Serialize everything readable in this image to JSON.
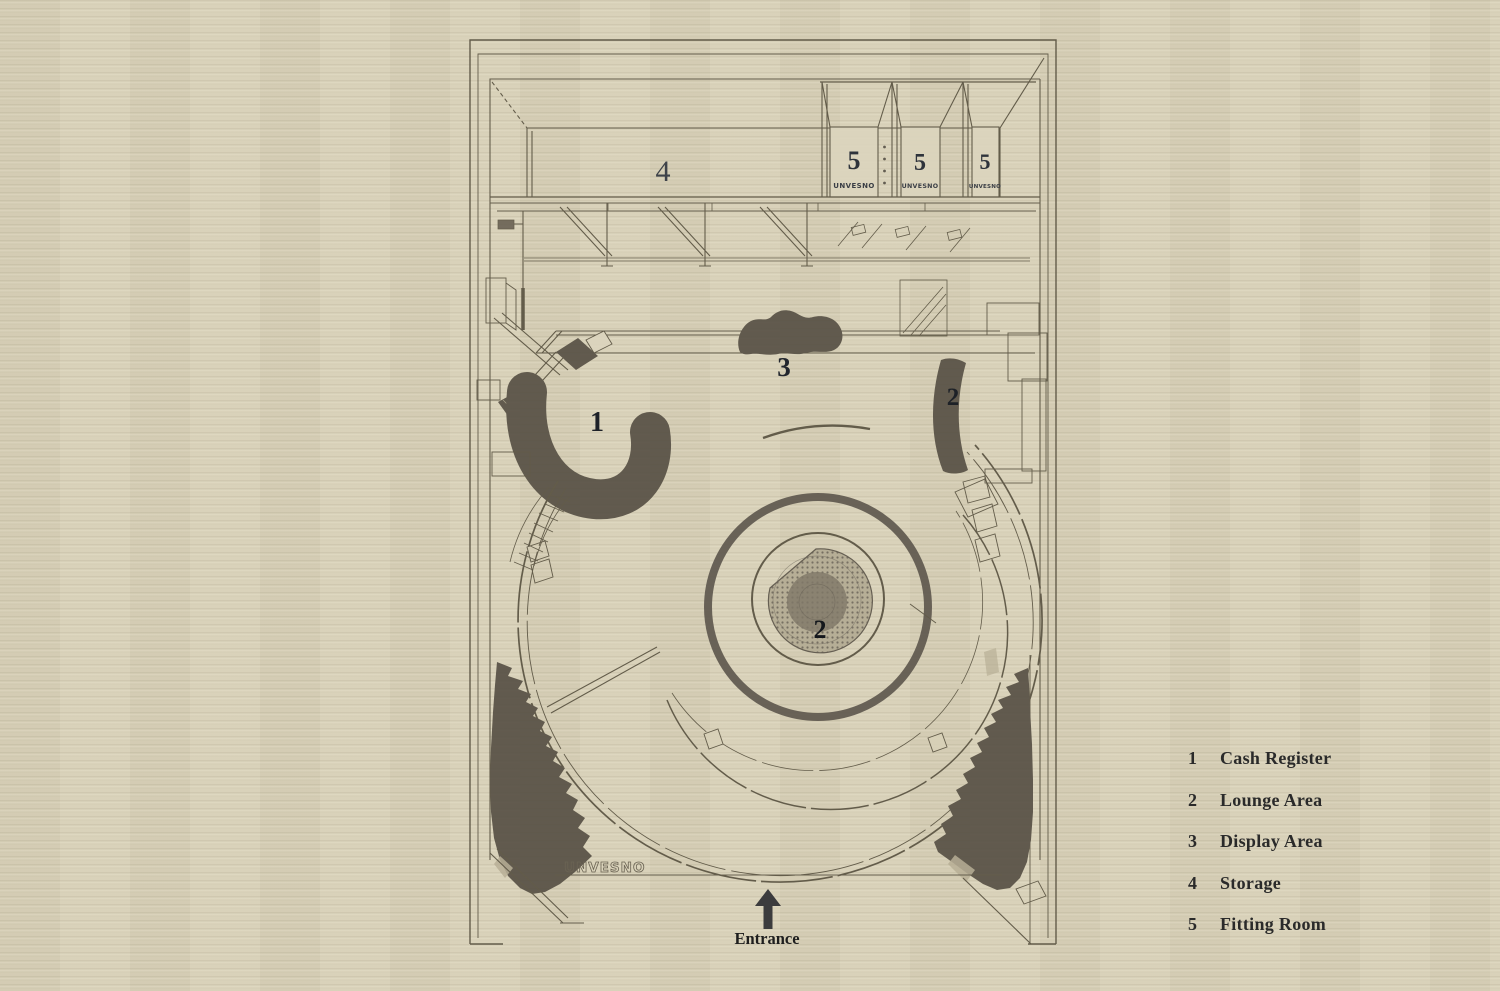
{
  "plan": {
    "storage_label": "4",
    "display_label": "3",
    "cash_label": "1",
    "lounge_right_label": "2",
    "lounge_center_label": "2",
    "fitting_rooms": [
      {
        "number": "5",
        "brand": "UNVESNO"
      },
      {
        "number": "5",
        "brand": "UNVESNO"
      },
      {
        "number": "5",
        "brand": "UNVESNO"
      }
    ],
    "storefront_brand": "UNVESNO",
    "entrance_label": "Entrance"
  },
  "legend": {
    "items": [
      {
        "number": "1",
        "label": "Cash Register"
      },
      {
        "number": "2",
        "label": "Lounge Area"
      },
      {
        "number": "3",
        "label": "Display Area"
      },
      {
        "number": "4",
        "label": "Storage"
      },
      {
        "number": "5",
        "label": "Fitting Room"
      }
    ]
  },
  "colors": {
    "paper": "#d8d1b8",
    "ink": "#57503f",
    "dark_fill": "#554e43",
    "label_ink": "#262b33"
  }
}
